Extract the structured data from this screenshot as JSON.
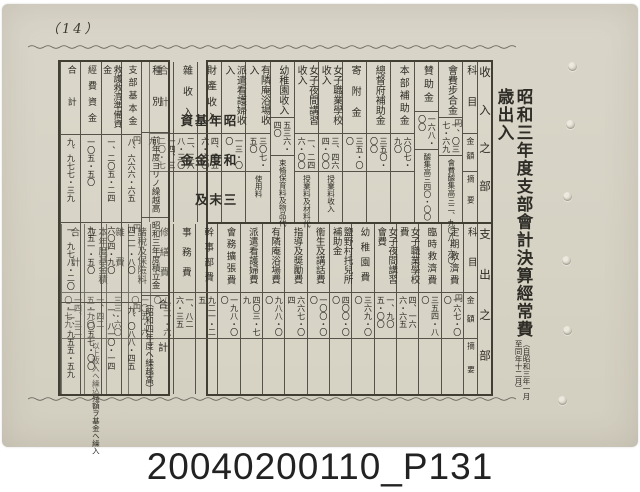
{
  "page": {
    "page_number": "（14）",
    "caption": "20040200110_P131"
  },
  "right_title": {
    "main": "昭和三年度支部會計決算經常費歳出入",
    "note_right": "（自昭和三年一月",
    "note_left": "至同年十二月）"
  },
  "main_table": {
    "headers": {
      "item": "科目",
      "amount": "金額",
      "note": "摘要"
    },
    "income": {
      "band_label": "收入之部",
      "entries": [
        {
          "item": "會費步合金",
          "amount": "一、〇三七・六九",
          "note": "會費醵集高三二、九〇八・六〇",
          "yen_on": [
            "amount"
          ]
        },
        {
          "item": "賛助金",
          "amount": "一六八・〇〇",
          "note": "醵集高三四〇・〇〇"
        },
        {
          "item": "本部補助金",
          "amount": "六〇七・九〇",
          "note": ""
        },
        {
          "item": "總督府補助金",
          "amount": "三五〇・〇〇",
          "note": ""
        },
        {
          "item": "寄附金",
          "amount": "三五・〇〇",
          "note": ""
        },
        {
          "item": "女子職業學校收入",
          "amount": "三、四六四・〇〇",
          "note": "授業料收入"
        },
        {
          "item": "女子夜間講習收入",
          "amount": "一、二四六・〇〇",
          "note": "授業料及材料代"
        },
        {
          "item": "幼稚園收入",
          "amount": "五三六・四〇",
          "note": "束脩保育料及物品代"
        },
        {
          "item": "有隣庵浴場收入",
          "amount": "三〇七・五〇",
          "note": "使用料"
        },
        {
          "item": "派遣看護婦收入",
          "amount": "一三・〇〇",
          "note": ""
        },
        {
          "item": "財產收入",
          "amount": "四、三五六・六〇",
          "note": ""
        },
        {
          "item": "雜收入",
          "amount": "二、三六八・三〇",
          "note": ""
        },
        {
          "item": "合計",
          "amount": "一四、三二〇・七九",
          "note": ""
        }
      ]
    },
    "expense": {
      "band_label": "支出之部",
      "entries": [
        {
          "item": "定期救濟費",
          "amount": "一六七・〇〇",
          "note": "",
          "yen_on": [
            "amount"
          ]
        },
        {
          "item": "臨時救濟費",
          "amount": "三五四・八〇",
          "note": ""
        },
        {
          "item": "女子職業學校費",
          "amount": "四、一六六・六五",
          "note": ""
        },
        {
          "item": "女子夜間講習會費",
          "amount": "一、九〇五・〇〇",
          "note": ""
        },
        {
          "item": "幼稚園費",
          "amount": "三六九・〇〇",
          "note": ""
        },
        {
          "item": "鹽野村托兒所補助金",
          "amount": "四〇〇・〇〇",
          "note": ""
        },
        {
          "item": "衞生及講話費",
          "amount": "一〇〇・〇〇",
          "note": ""
        },
        {
          "item": "指導及奬勵費",
          "amount": "六六七・〇四",
          "note": ""
        },
        {
          "item": "有隣庵浴場費",
          "amount": "九八八・〇〇",
          "note": ""
        },
        {
          "item": "派遣看護婦費",
          "amount": "四〇三・七九",
          "note": ""
        },
        {
          "item": "會務擴張費",
          "amount": "一九八・〇〇",
          "note": ""
        },
        {
          "item": "幹事部費",
          "amount": "九二一・二五",
          "note": ""
        },
        {
          "item": "事務費",
          "amount": "一、八二六・三五",
          "note": ""
        },
        {
          "item": "修繕費",
          "amount": "八三一・六〇",
          "note": ""
        },
        {
          "item": "諸稅及保險料",
          "amount": "一〇五・六〇",
          "note": ""
        },
        {
          "item": "雜費",
          "amount": "三三・六〇",
          "note": ""
        },
        {
          "item": "本年度基金積立",
          "amount": "一、四二五・九〇",
          "note": "以上收入ヘ繰込殘額ヲ基金ヘ繰入"
        },
        {
          "item": "合計",
          "amount": "一四、三二〇・七九",
          "note": ""
        }
      ]
    }
  },
  "left_table": {
    "title": "昭和三年度末基金及資金",
    "row_headers": {
      "kind": "種別",
      "carryover": "前年度ヨリノ繰越高",
      "reserve": "昭和三年度積立金"
    },
    "total_label": "合計",
    "total_note": "（昭和四年度ヘ繰越高）",
    "columns": [
      {
        "name": "支部基本金",
        "carryover": "八、六六六・六五",
        "reserve": "四二一・八〇",
        "total": "九、〇八八・四五",
        "yen_on": [
          "carryover",
          "reserve",
          "total"
        ]
      },
      {
        "name": "救護救濟準備資金",
        "carryover": "一、二〇五・二四",
        "reserve": "六〇四・九〇",
        "total": "一、八一〇・一四"
      },
      {
        "name": "經費資金",
        "carryover": "一〇五・五〇",
        "reserve": "九五一・五〇",
        "total": "一、〇五七・〇〇"
      },
      {
        "name": "合計",
        "carryover": "九、九七七・三九",
        "reserve": "一、九七八・二〇",
        "total": "一一、九五五・五九"
      }
    ]
  },
  "colors": {
    "paper": "#d6d2c4",
    "ink": "#2e2c26",
    "rule": "#55524a"
  }
}
